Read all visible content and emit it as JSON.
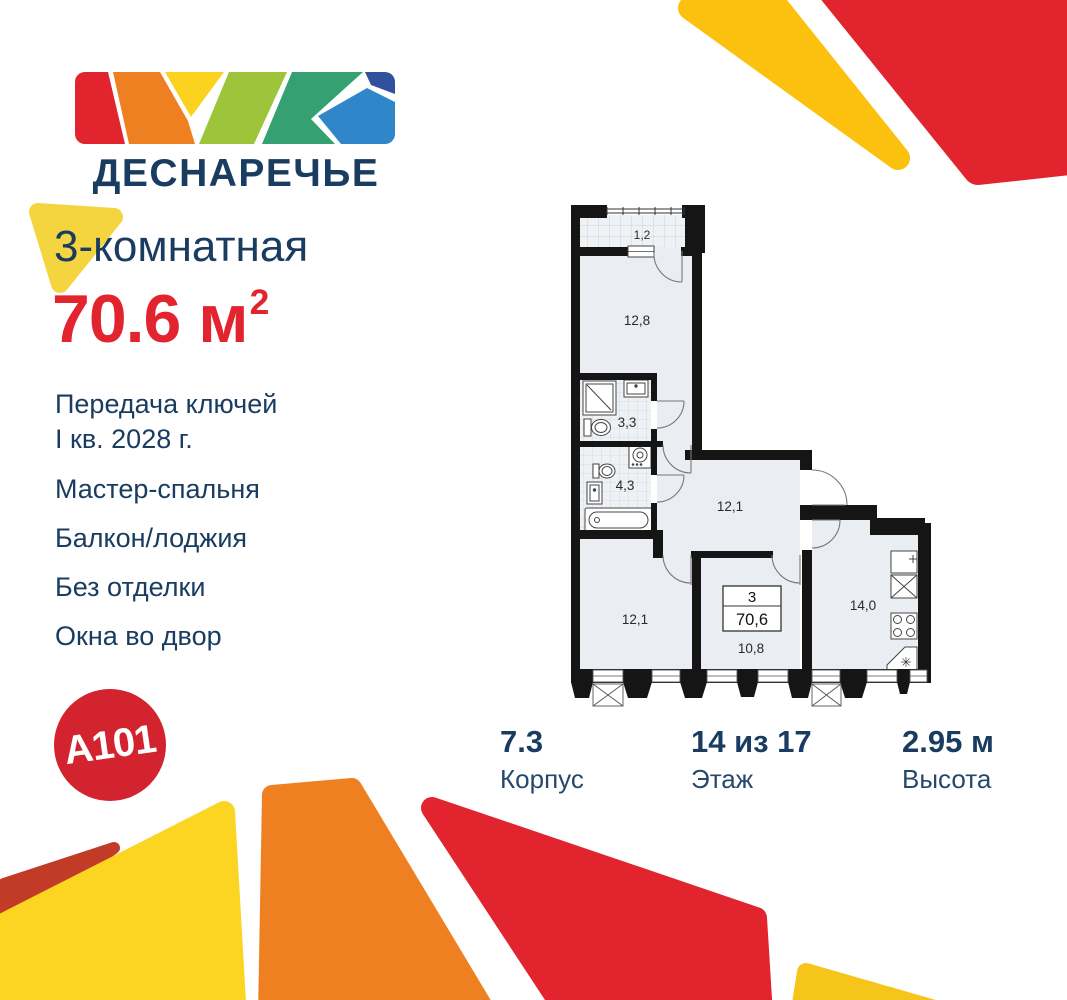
{
  "palette": {
    "navy": "#1a3c61",
    "red": "#e2242e",
    "red_developer": "#d2232e",
    "orange": "#ef8022",
    "yellow_gold": "#fbc10e",
    "yellow_soft": "#f4d53f",
    "yellow_bright": "#fcd422",
    "brick": "#c23b27",
    "logo_green_light": "#9dc43b",
    "logo_teal": "#35a173",
    "logo_blue_dark": "#31519e",
    "logo_blue_mid": "#2f87c9"
  },
  "logo": {
    "project_name": "ДЕСНАРЕЧЬЕ"
  },
  "listing": {
    "type_label": "3-комнатная",
    "area_value": "70.6",
    "area_unit": "м",
    "area_exponent": "2",
    "features": [
      "Передача ключей",
      "I кв. 2028 г.",
      "Мастер-спальня",
      "Балкон/лоджия",
      "Без отделки",
      "Окна во двор"
    ]
  },
  "developer": {
    "name": "A101"
  },
  "stats": [
    {
      "value": "7.3",
      "label": "Корпус"
    },
    {
      "value": "14 из 17",
      "label": "Этаж"
    },
    {
      "value": "2.95 м",
      "label": "Высота"
    }
  ],
  "plan": {
    "rooms": [
      {
        "id": "balcony",
        "area": "1,2"
      },
      {
        "id": "bedroom-top",
        "area": "12,8"
      },
      {
        "id": "shower-room",
        "area": "3,3"
      },
      {
        "id": "bathroom",
        "area": "4,3"
      },
      {
        "id": "hallway",
        "area": "12,1"
      },
      {
        "id": "bedroom-left",
        "area": "12,1"
      },
      {
        "id": "room-center",
        "area": "10,8"
      },
      {
        "id": "kitchen",
        "area": "14,0"
      }
    ],
    "info_box": {
      "rooms_count": "3",
      "total_area": "70,6"
    }
  }
}
